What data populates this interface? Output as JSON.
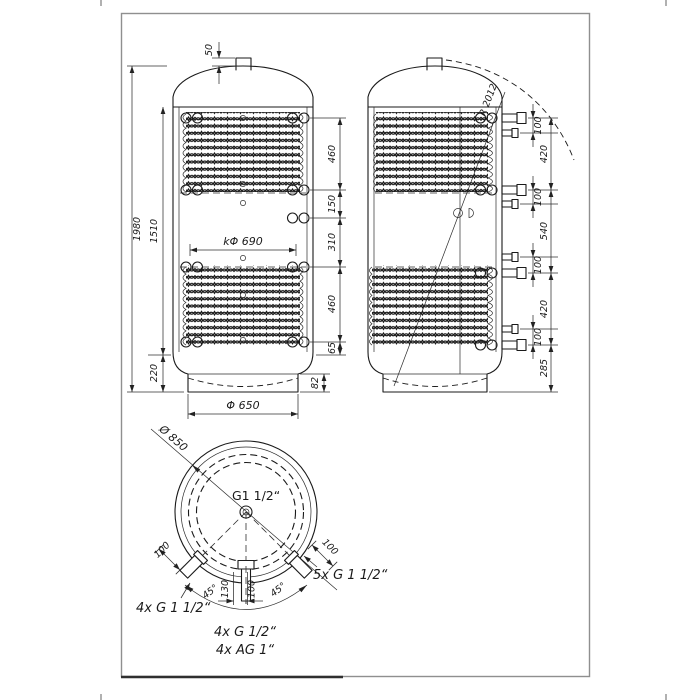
{
  "front_view": {
    "nozzle_height": "50",
    "total_height": "1980",
    "shell_height": "1510",
    "base_height": "220",
    "upper_coil_height": "460",
    "gap_upper": "150",
    "gap_middle": "310",
    "lower_coil_height": "460",
    "coil_bottom_offset": "65",
    "skirt_height": "82",
    "flange_circle": "kΦ 690",
    "base_diameter": "Φ 650"
  },
  "side_view": {
    "dome_radius": "R 2012",
    "pair_spacing_1": "100",
    "pair_spacing_2": "100",
    "pair_spacing_3": "100",
    "pair_spacing_4": "100",
    "upper_span": "420",
    "middle_span": "540",
    "lower_span": "420",
    "bottom_offset": "285"
  },
  "top_view": {
    "outer_diameter": "Ø 850",
    "center_connection": "G1 1/2“",
    "left_stub_length": "100",
    "right_stub_length": "100",
    "left_angle": "45°",
    "right_angle": "45°",
    "offset_130": "130",
    "offset_100": "100",
    "connections_left": "4x G 1 1/2“",
    "connections_right": "5x G 1 1/2“",
    "connections_bottom_small": "4x G 1/2“",
    "connections_bottom_ag": "4x AG 1“"
  }
}
